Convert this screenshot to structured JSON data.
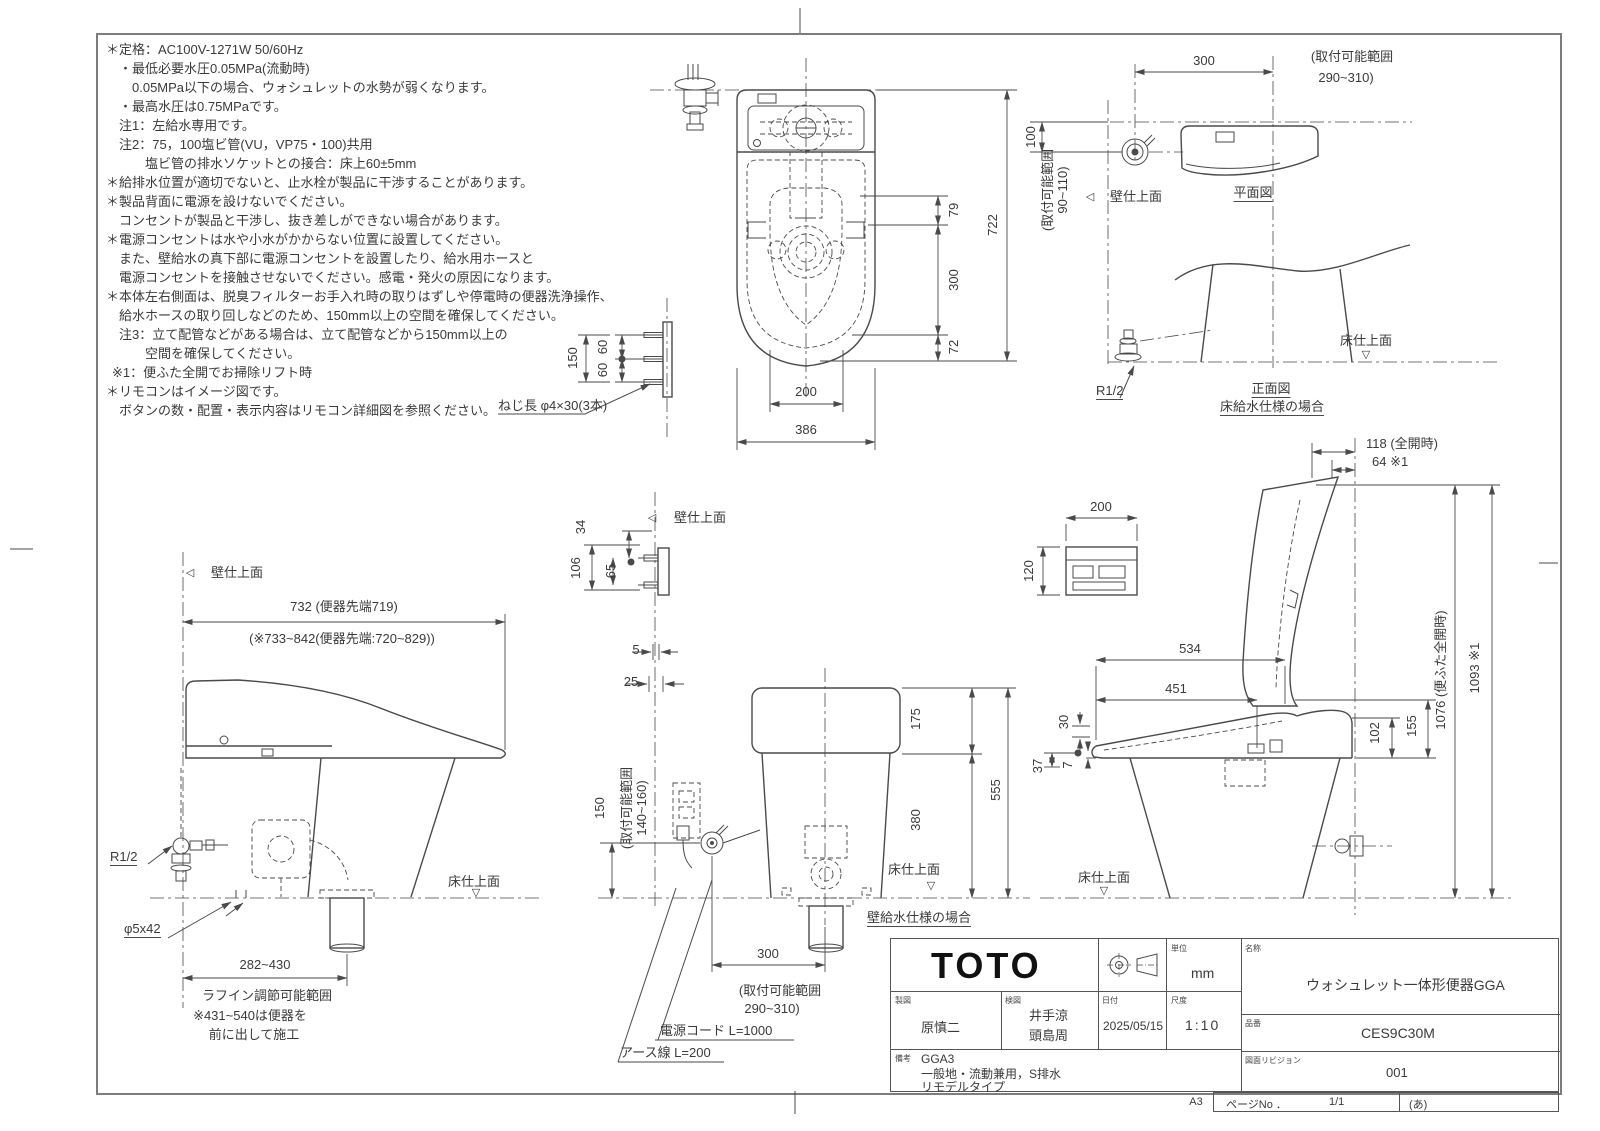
{
  "colors": {
    "line": "#4a4a4a",
    "text": "#3a3a3a",
    "background": "#ffffff",
    "frame": "#7d7d7d"
  },
  "markers": {
    "wall_triangle": "◁",
    "floor_triangle": "▽"
  },
  "notes": {
    "lines": [
      "＊定格：AC100V-1271W 50/60Hz",
      "・最低必要水圧0.05MPa(流動時)",
      "0.05MPa以下の場合、ウォシュレットの水勢が弱くなります。",
      "・最高水圧は0.75MPaです。",
      "注1：左給水専用です。",
      "注2：75，100塩ビ管(VU，VP75・100)共用",
      "塩ビ管の排水ソケットとの接合：床上60±5mm",
      "＊給排水位置が適切でないと、止水栓が製品に干渉することがあります。",
      "＊製品背面に電源を設けないでください。",
      "コンセントが製品と干渉し、抜き差しができない場合があります。",
      "＊電源コンセントは水や小水がかからない位置に設置してください。",
      "また、壁給水の真下部に電源コンセントを設置したり、給水用ホースと",
      "電源コンセントを接触させないでください。感電・発火の原因になります。",
      "＊本体左右側面は、脱臭フィルターお手入れ時の取りはずしや停電時の便器洗浄操作、",
      "給水ホースの取り回しなどのため、150mm以上の空間を確保してください。",
      "注3：立て配管などがある場合は、立て配管などから150mm以上の",
      "空間を確保してください。",
      "※1：便ふた全開でお掃除リフト時",
      "＊リモコンはイメージ図です。",
      "ボタンの数・配置・表示内容はリモコン詳細図を参照ください。"
    ]
  },
  "screw_detail": {
    "dim_150": "150",
    "dim_60a": "60",
    "dim_60b": "60",
    "label": "ねじ長 φ4×30(3本)"
  },
  "plan_view": {
    "dim_79": "79",
    "dim_722": "722",
    "dim_300": "300",
    "dim_72": "72",
    "dim_200": "200",
    "dim_386": "386"
  },
  "cistern_plan": {
    "dim_300": "300",
    "range_l1": "(取付可能範囲",
    "range_l2": "290~310)",
    "dim_100": "100",
    "range_v_l1": "(取付可能範囲",
    "range_v_l2": "90~110)",
    "wall_label": "壁仕上面",
    "title": "平面図"
  },
  "front_floor": {
    "r12": "R1/2",
    "floor_label": "床仕上面",
    "title": "正面図",
    "subtitle": "床給水仕様の場合"
  },
  "left_side": {
    "wall_label": "壁仕上面",
    "dim_732": "732 (便器先端719)",
    "dim_range": "(※733~842(便器先端:720~829))",
    "r12": "R1/2",
    "phi": "φ5x42",
    "dim_282": "282~430",
    "roughin": "ラフイン調節可能範囲",
    "note1": "※431~540は便器を",
    "note2": "前に出して施工",
    "floor_label": "床仕上面"
  },
  "rear_wall": {
    "wall_label": "壁仕上面",
    "dim_34": "34",
    "dim_106": "106",
    "dim_65": "65",
    "dim_5": "5",
    "dim_25": "25",
    "dim_150": "150",
    "range_l1": "(取付可能範囲",
    "range_l2": "140~160)",
    "dim_175": "175",
    "dim_380": "380",
    "dim_555": "555",
    "floor_label": "床仕上面",
    "dim_300": "300",
    "range300_l1": "(取付可能範囲",
    "range300_l2": "290~310)",
    "cord": "電源コード L=1000",
    "earth": "アース線 L=200",
    "caption": "壁給水仕様の場合"
  },
  "right_side": {
    "dim_118": "118 (全開時)",
    "dim_64": "64 ※1",
    "dim_200": "200",
    "dim_120": "120",
    "dim_534": "534",
    "dim_451": "451",
    "dim_30": "30",
    "dim_37": "37",
    "dim_7": "7",
    "dim_155": "155",
    "dim_102": "102",
    "dim_1076": "1076 (便ふた全開時)",
    "dim_1093": "1093 ※1",
    "floor_label": "床仕上面"
  },
  "title_block": {
    "brand": "TOTO",
    "unit_label": "単位",
    "unit_value": "mm",
    "drafter_label": "製図",
    "drafter": "原慎二",
    "checker_label": "検図",
    "checker1": "井手涼",
    "checker2": "頭島周",
    "date_label": "日付",
    "date": "2025/05/15",
    "scale_label": "尺度",
    "scale": "1:10",
    "remarks_label": "備考",
    "remarks1": "GGA3",
    "remarks2": "一般地・流動兼用，S排水",
    "remarks3": "リモデルタイプ",
    "name_label": "名称",
    "name": "ウォシュレット一体形便器GGA",
    "part_label": "品番",
    "part": "CES9C30M",
    "rev_label": "図面リビジョン",
    "rev": "001"
  },
  "footer": {
    "paper_size": "A3",
    "page_label": "ページNo ．",
    "page_value": "1/1",
    "sheet_code": "(あ)"
  }
}
